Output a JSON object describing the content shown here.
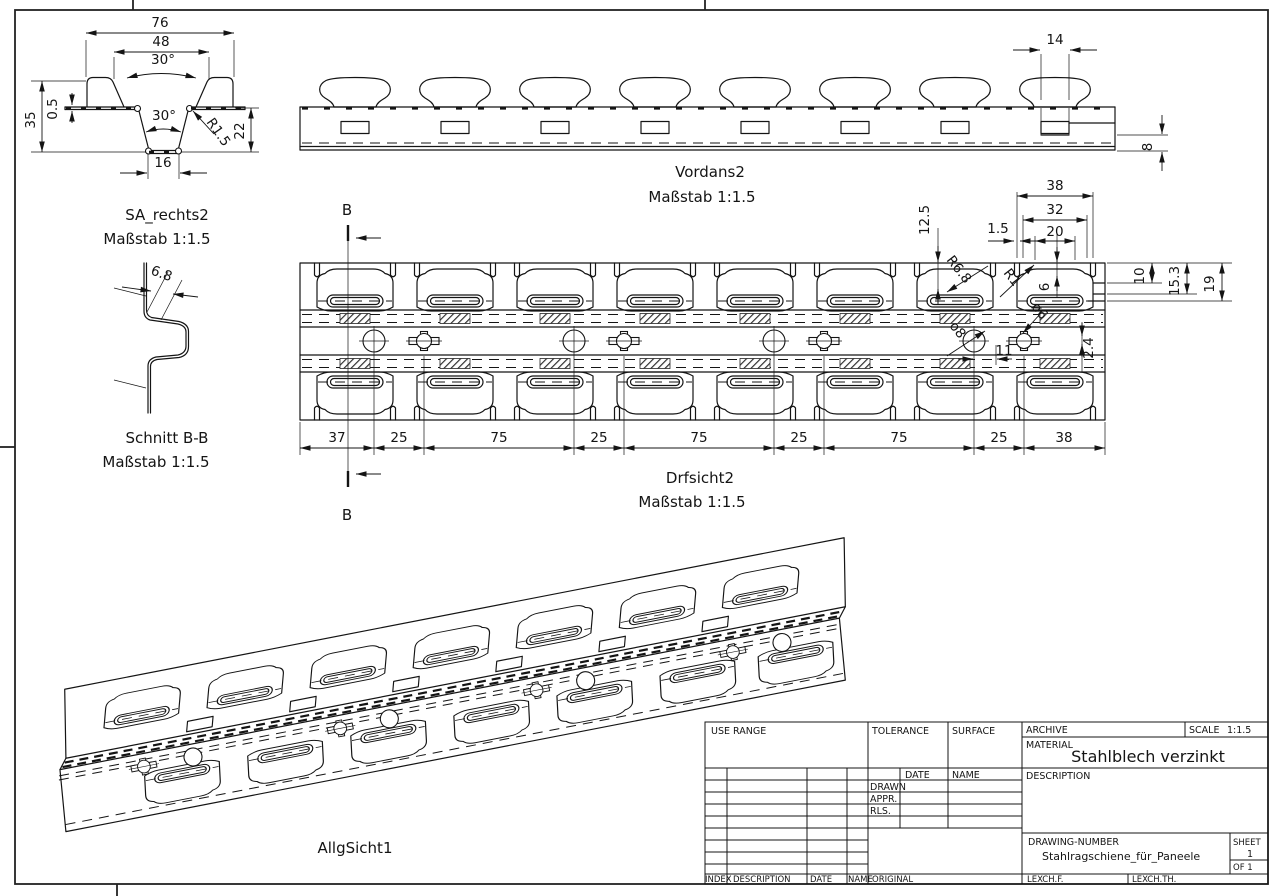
{
  "sheet": {
    "background": "#ffffff",
    "line_color": "#141414"
  },
  "views": {
    "section_right": {
      "title": "SA_rechts2",
      "scale": "Maßstab 1:1.5",
      "dims": {
        "width_outer": "76",
        "width_inner": "48",
        "angle_upper": "30°",
        "angle_lower": "30°",
        "thickness": "0.5",
        "height_total": "35",
        "height_right": "22",
        "radius": "R1.5",
        "width_bottom": "16"
      }
    },
    "front": {
      "title": "Vordans2",
      "scale": "Maßstab 1:1.5",
      "dims": {
        "stud_width": "14",
        "edge_height": "8"
      }
    },
    "section_bb": {
      "title": "Schnitt B-B",
      "scale": "Maßstab 1:1.5",
      "mark": "B",
      "dims": {
        "web_offset": "6.8"
      }
    },
    "plan": {
      "title": "Drfsicht2",
      "scale": "Maßstab 1:1.5",
      "dims": {
        "pitch_outer": "38",
        "cutout_outer": "32",
        "cutout_inner": "20",
        "slot_width": "1.5",
        "depth_slot": "12.5",
        "depth_top": "6",
        "radius_large": "R6.8",
        "radius_small": "R1",
        "edge_10": "10",
        "edge_15_3": "15.3",
        "edge_19": "19",
        "hole_dia": "ø8",
        "clover_dia": "ø6",
        "tab_height": "2.4",
        "hole_offset": "11"
      },
      "bottom_dims": [
        "37",
        "25",
        "75",
        "25",
        "75",
        "25",
        "75",
        "25",
        "38"
      ]
    },
    "iso": {
      "title": "AllgSicht1"
    }
  },
  "titleblock": {
    "use_range": "USE RANGE",
    "tolerance": "TOLERANCE",
    "surface": "SURFACE",
    "archive": "ARCHIVE",
    "scale_label": "SCALE",
    "scale_value": "1:1.5",
    "material_label": "MATERIAL",
    "material_value": "Stahlblech verzinkt",
    "date": "DATE",
    "name": "NAME",
    "drawn": "DRAWN",
    "appr": "APPR.",
    "rls": "RLS.",
    "description": "DESCRIPTION",
    "drawing_number_label": "DRAWING-NUMBER",
    "drawing_number": "Stahlragschiene_für_Paneele",
    "sheet_label": "SHEET",
    "sheet_value": "1",
    "of_value": "OF 1",
    "index": "INDEX",
    "description_col": "DESCRIPTION",
    "date_col": "DATE",
    "name_col": "NAME",
    "original": "ORIGINAL",
    "lexch_f": "LEXCH.F.",
    "lexch_th": "LEXCH.TH."
  }
}
